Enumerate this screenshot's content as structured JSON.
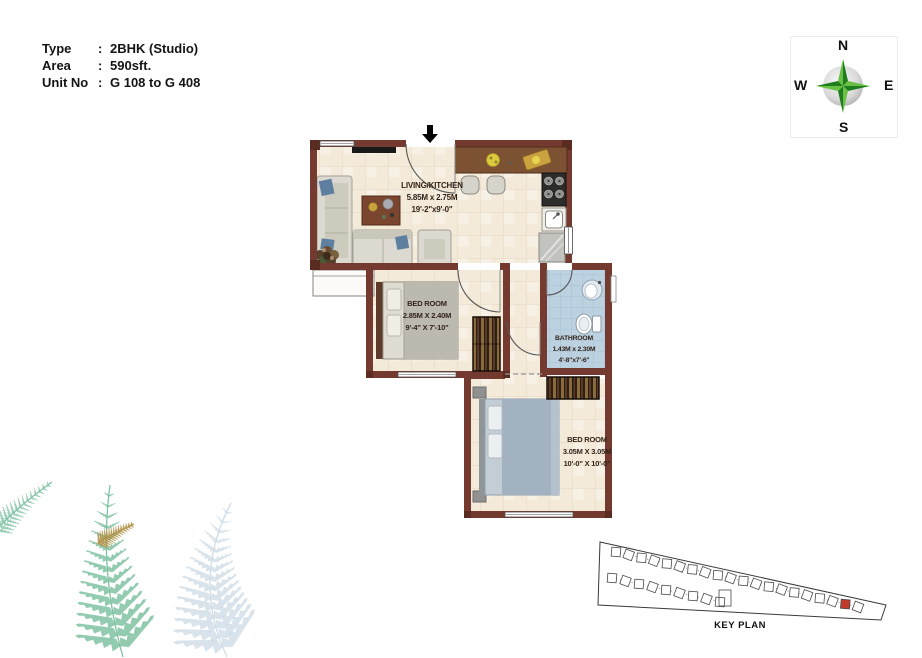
{
  "info": {
    "rows": [
      {
        "label": "Type",
        "sep": ":",
        "value": "2BHK (Studio)"
      },
      {
        "label": "Area",
        "sep": ":",
        "value": "590sft."
      },
      {
        "label": "Unit No",
        "sep": ":",
        "value": "G 108 to G 408"
      }
    ]
  },
  "compass": {
    "north": "N",
    "south": "S",
    "east": "E",
    "west": "W",
    "star_light": "#6abf45",
    "star_dark": "#1e7e1e"
  },
  "floor_plan": {
    "rooms": [
      {
        "name": "LIVING/KITCHEN",
        "dim_metric": "5.85M x 2.75M",
        "dim_imperial": "19'-2\"x9'-0\""
      },
      {
        "name": "BED ROOM",
        "dim_metric": "2.85M X 2.40M",
        "dim_imperial": "9'-4\" X 7'-10\""
      },
      {
        "name": "BATHROOM",
        "dim_metric": "1.43M x 2.30M",
        "dim_imperial": "4'-8\"x7'-6\""
      },
      {
        "name": "BED ROOM",
        "dim_metric": "3.05M X 3.05M",
        "dim_imperial": "10'-0\" X 10'-0\""
      }
    ],
    "colors": {
      "wall": "#753a2f",
      "floor": "#f4ead9",
      "floor_line": "#e4d5bf",
      "bath_floor": "#bdd2e0",
      "bath_line": "#a6c0d2",
      "counter": "#7c5233",
      "wardrobe": "#2e1f15",
      "bed2_blanket": "#a2b2c0"
    }
  },
  "key_plan": {
    "label": "KEY PLAN",
    "highlight_color": "#c0392b"
  },
  "decor": {
    "fern_green": "#7fc2a2",
    "fern_blue": "#cfdce6",
    "leaf_gold": "#b2934b"
  }
}
